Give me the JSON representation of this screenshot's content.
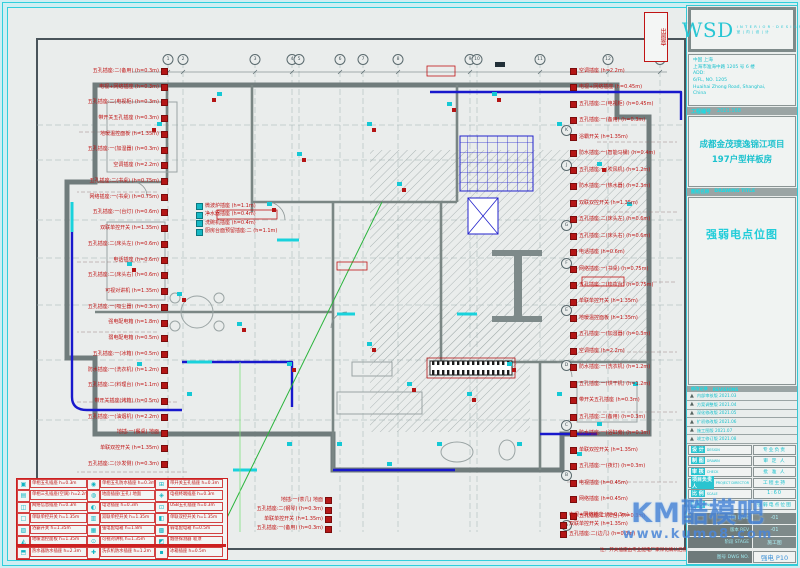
{
  "watermark": {
    "brand": "KM酷模吧",
    "url": "www.kumo8.com"
  },
  "title_block": {
    "logo": {
      "text": "WSD",
      "sub1": "I N T E R I O R · D E S I G N",
      "sub2": "室 | 内 | 设 | 计"
    },
    "address_lines": [
      "中国 上海",
      "上海市淮海中路 1205 号 6 楼",
      "ADD:",
      "6/FL, NO. 1205",
      "Huaihai Zhong Road, Shanghai,",
      "China"
    ],
    "project_no_label": "工程编号",
    "project_no": "2021.168",
    "project_name_line1": "成都金茂璞逸锦江项目",
    "project_name_line2": "197户型样板房",
    "drawing_title_label_cn": "图纸名称",
    "drawing_title_label_en": "DRAWING TITLE",
    "drawing_title": "强弱电点位图",
    "revisions_label_cn": "修改记录",
    "revisions_label_en": "REVISIONS",
    "revisions": [
      {
        "mark": "▲",
        "text": "内部审核版 2021.03"
      },
      {
        "mark": "▲",
        "text": "方案调整版 2021.04"
      },
      {
        "mark": "▲",
        "text": "深化修改版 2021.05"
      },
      {
        "mark": "▲",
        "text": "扩初修改版 2021.06"
      },
      {
        "mark": "▲",
        "text": "施工图版 2021.07"
      },
      {
        "mark": "▲",
        "text": "竣工修订版 2021.08"
      }
    ],
    "fields": [
      {
        "cn": "设 计",
        "en": "DESIGN",
        "val": "专业负责"
      },
      {
        "cn": "制 图",
        "en": "DRAWN",
        "val": "审 定 人"
      },
      {
        "cn": "审 核",
        "en": "CHECK",
        "val": "批 准 人"
      },
      {
        "cn": "项目负责人",
        "en": "PROJECT DIRECTOR",
        "val": "工程主持"
      },
      {
        "cn": "比 例",
        "en": "SCALE",
        "val": "1:60"
      },
      {
        "cn": "图 号",
        "en": "NO.",
        "val": "强弱电点位图"
      }
    ],
    "dark_rows": [
      {
        "label": "日期 DATE",
        "val": "-01"
      },
      {
        "label": "版本 REV",
        "val": "-01"
      },
      {
        "label": "阶段 STAGE",
        "val": "施工图"
      }
    ],
    "sheet_no_label": "图号 DWG NO.",
    "sheet_no": "强电 P10"
  },
  "legend": {
    "items": [
      {
        "sym": "▣",
        "label": "单相五孔插座 h=0.3m"
      },
      {
        "sym": "◉",
        "label": "单相五孔防水插座 h=0.3m"
      },
      {
        "sym": "⊞",
        "label": "带开关五孔插座 h=0.3m"
      },
      {
        "sym": "▤",
        "label": "单相三孔插座(空调) h=2.2m"
      },
      {
        "sym": "◍",
        "label": "地面插座(五孔) 地面"
      },
      {
        "sym": "◈",
        "label": "电视终端插座 h=0.3m"
      },
      {
        "sym": "◫",
        "label": "网络信息插座 h=0.3m"
      },
      {
        "sym": "◐",
        "label": "电话插座 h=0.3m"
      },
      {
        "sym": "⊡",
        "label": "USB五孔插座 h=0.3m"
      },
      {
        "sym": "□",
        "label": "单联单控开关 h=1.35m"
      },
      {
        "sym": "▥",
        "label": "双联单控开关 h=1.35m"
      },
      {
        "sym": "◧",
        "label": "单联双控开关 h=1.35m"
      },
      {
        "sym": "▨",
        "label": "浴霸开关 h=1.35m"
      },
      {
        "sym": "▦",
        "label": "强电配电箱 h=1.8m"
      },
      {
        "sym": "▩",
        "label": "弱电配电箱 h=0.5m"
      },
      {
        "sym": "◭",
        "label": "地暖温控面板 h=1.35m"
      },
      {
        "sym": "⊙",
        "label": "可视对讲机 h=1.35m"
      },
      {
        "sym": "◩",
        "label": "烟感探测器 吸顶"
      },
      {
        "sym": "⬒",
        "label": "热水器防水插座 h=2.3m"
      },
      {
        "sym": "✚",
        "label": "洗衣机防水插座 h=1.2m"
      },
      {
        "sym": "▪",
        "label": "冰箱插座 h=0.5m"
      }
    ]
  },
  "plan": {
    "note": "注：开关插座由专业配电厂家深化确认后施工",
    "stamp": "出图章",
    "grid_top": [
      {
        "x": 168,
        "label": "1"
      },
      {
        "x": 183,
        "label": "2"
      },
      {
        "x": 255,
        "label": "3"
      },
      {
        "x": 292,
        "label": "4"
      },
      {
        "x": 299,
        "label": "5"
      },
      {
        "x": 340,
        "label": "6"
      },
      {
        "x": 363,
        "label": "7"
      },
      {
        "x": 398,
        "label": "8"
      },
      {
        "x": 470,
        "label": "9"
      },
      {
        "x": 477,
        "label": "10"
      },
      {
        "x": 540,
        "label": "11"
      },
      {
        "x": 608,
        "label": "12"
      },
      {
        "x": 660,
        "label": "13"
      }
    ],
    "grid_letters": [
      {
        "y": 125,
        "label": "K"
      },
      {
        "y": 160,
        "label": "J"
      },
      {
        "y": 220,
        "label": "G"
      },
      {
        "y": 258,
        "label": "F"
      },
      {
        "y": 305,
        "label": "E"
      },
      {
        "y": 360,
        "label": "D"
      },
      {
        "y": 420,
        "label": "C"
      },
      {
        "y": 470,
        "label": "B"
      },
      {
        "y": 520,
        "label": "A"
      }
    ],
    "left_labels": [
      "五孔插座:二(备用) (h=0.3m)",
      "电视+网络插座 (h=0.3m)",
      "五孔插座:二(电视柜) (h=0.3m)",
      "带开关五孔插座 (h=0.3m)",
      "地暖温控面板 (h=1.35m)",
      "五孔插座:一(加湿器) (h=0.3m)",
      "空调插座 (h=2.2m)",
      "五孔插座:二(书桌) (h=0.75m)",
      "网络插座:一(书桌) (h=0.75m)",
      "五孔插座:一(台灯) (h=0.6m)",
      "双联单控开关 (h=1.35m)",
      "五孔插座:二(床头左) (h=0.6m)",
      "电话插座 (h=0.6m)",
      "五孔插座:二(床头右) (h=0.6m)",
      "可视对讲机 (h=1.35m)",
      "五孔插座:一(吸尘器) (h=0.3m)",
      "强电配电箱 (h=1.8m)",
      "弱电配电箱 (h=0.5m)",
      "五孔插座:一(冰箱) (h=0.5m)",
      "防水插座:一(洗衣机) (h=1.2m)",
      "五孔插座:二(料理台) (h=1.1m)",
      "带开关插座(烤箱) (h=0.5m)",
      "五孔插座:一(油烟机) (h=2.2m)",
      "地插:一(餐桌) 地面",
      "单联双控开关 (h=1.35m)",
      "五孔插座:二(沙发侧) (h=0.3m)"
    ],
    "right_labels": [
      "空调插座 (h=2.2m)",
      "电视+网络插座 (h=0.45m)",
      "五孔插座:二(电视柜) (h=0.45m)",
      "五孔插座:一(备用) (h=0.3m)",
      "浴霸开关 (h=1.35m)",
      "防水插座:一(智能马桶) (h=0.4m)",
      "五孔插座:一(吹风机) (h=1.2m)",
      "防水插座:一(热水器) (h=2.3m)",
      "双联双控开关 (h=1.35m)",
      "五孔插座:二(床头左) (h=0.6m)",
      "五孔插座:二(床头右) (h=0.6m)",
      "电话插座 (h=0.6m)",
      "网络插座:一(书桌) (h=0.75m)",
      "五孔插座:二(梳妆台) (h=0.75m)",
      "单联单控开关 (h=1.35m)",
      "地暖温控面板 (h=1.35m)",
      "五孔插座:一(加湿器) (h=0.3m)",
      "空调插座 (h=2.2m)",
      "防水插座:一(洗衣机) (h=1.2m)",
      "五孔插座:一(烘干机) (h=1.2m)",
      "带开关五孔插座 (h=0.3m)",
      "五孔插座:二(备用) (h=0.3m)",
      "防水插座:一(浴缸旁) (h=0.3m)",
      "单联双控开关 (h=1.35m)",
      "五孔插座:一(夜灯) (h=0.3m)",
      "电视插座 (h=0.45m)",
      "网络插座 (h=0.45m)",
      "五孔插座:二(阳台) (h=0.3m)"
    ],
    "bottom_labels_a": [
      "地插:一(茶几) 地面",
      "五孔插座:二(钢琴) (h=0.3m)",
      "单联单控开关 (h=1.35m)",
      "五孔插座:一(备用) (h=0.3m)"
    ],
    "bottom_labels_b": [
      "电视+网络插座 (h=0.3m)",
      "双联单控开关 (h=1.35m)",
      "五孔插座:二(边几) (h=0.3m)"
    ],
    "kitchen_cluster": [
      "微波炉插座 (h=1.1m)",
      "净水器插座 (h=0.4m)",
      "洗碗机插座 (h=0.4m)",
      "厨房台面预留插座:二 (h=1.1m)"
    ]
  }
}
